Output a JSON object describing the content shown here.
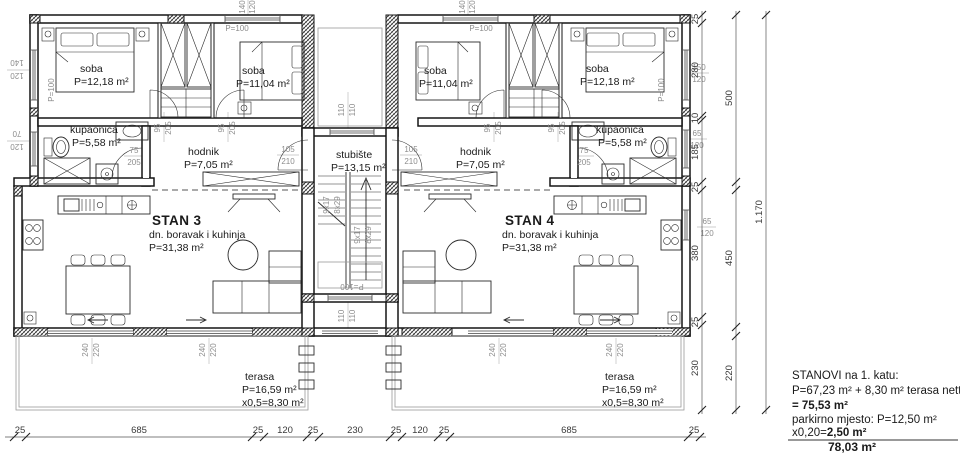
{
  "drawing": {
    "rooms": {
      "soba_l1": {
        "name": "soba",
        "area": "P=12,18 m²"
      },
      "soba_l2": {
        "name": "soba",
        "area": "P=11,04 m²"
      },
      "kupaonica_l": {
        "name": "kupaonica",
        "area": "P=5,58 m²"
      },
      "hodnik_l": {
        "name": "hodnik",
        "area": "P=7,05 m²"
      },
      "stubiste": {
        "name": "stubište",
        "area": "P=13,15 m²"
      },
      "soba_r1": {
        "name": "soba",
        "area": "P=11,04 m²"
      },
      "soba_r2": {
        "name": "soba",
        "area": "P=12,18 m²"
      },
      "kupaonica_r": {
        "name": "kupaonica",
        "area": "P=5,58 m²"
      },
      "hodnik_r": {
        "name": "hodnik",
        "area": "P=7,05 m²"
      },
      "stan3": {
        "name": "STAN 3",
        "desc": "dn. boravak i kuhinja",
        "area": "P=31,38 m²"
      },
      "stan4": {
        "name": "STAN 4",
        "desc": "dn. boravak i kuhinja",
        "area": "P=31,38 m²"
      },
      "terasa_l": {
        "name": "terasa",
        "area": "P=16,59 m²",
        "half": "x0,5=8,30 m²"
      },
      "terasa_r": {
        "name": "terasa",
        "area": "P=16,59 m²",
        "half": "x0,5=8,30 m²"
      }
    },
    "stairs": {
      "run": "9x17",
      "rise": "8x29",
      "door": "P=100"
    },
    "openings": {
      "w140": "140",
      "w120": "120",
      "w150": "150",
      "w70": "70",
      "w65": "65",
      "w110": "110",
      "w240": "240",
      "w220": "220",
      "d95": "95",
      "d205": "205",
      "d75": "75",
      "d105": "105",
      "d210": "210",
      "p100": "P=100"
    },
    "dims": {
      "bottom": [
        "25",
        "685",
        "25",
        "120",
        "25",
        "230",
        "25",
        "120",
        "25",
        "685",
        "25"
      ],
      "right_inner": [
        "25",
        "280",
        "10",
        "185",
        "25",
        "380",
        "25",
        "230"
      ],
      "right_outer": [
        "500",
        "450",
        "220"
      ],
      "total": "1.170"
    },
    "legend": {
      "line1": "STANOVI na 1. katu:",
      "line2": "P=67,23 m² + 8,30 m² terasa netto",
      "line3": "= 75,53 m²",
      "line4": "parkirno mjesto: P=12,50 m²",
      "line5a": "x0,20=",
      "line5b": "2,50 m²",
      "total": "78,03 m²"
    }
  }
}
